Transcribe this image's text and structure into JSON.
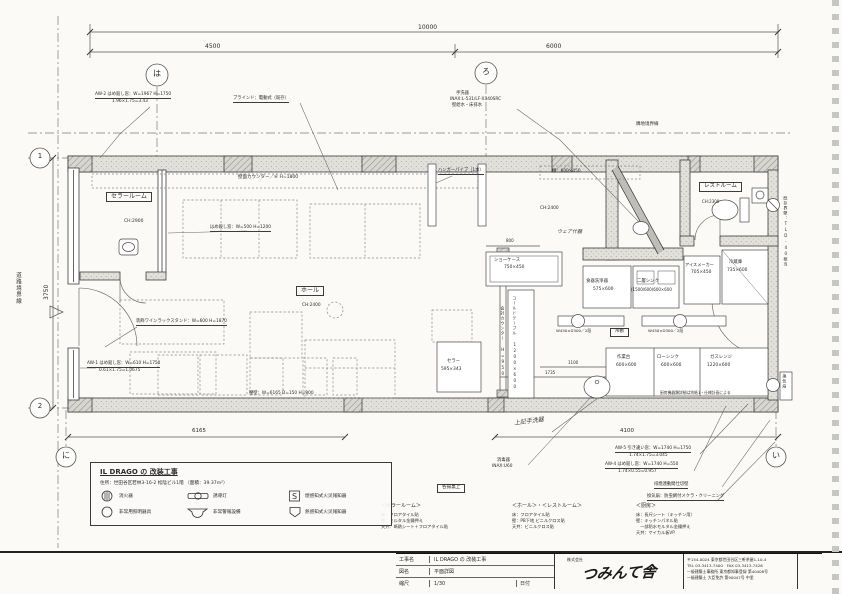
{
  "dims": {
    "overall": "10000",
    "span_left": "4500",
    "span_right": "6000",
    "depth": "3750",
    "bottom_left": "6165",
    "bottom_right": "4100",
    "inner_800": "800",
    "inner_1100": "1100",
    "inner_1735": "1735"
  },
  "grid": {
    "ha": "は",
    "ro": "ろ",
    "one": "1",
    "two": "2",
    "ni": "に",
    "i": "い"
  },
  "boundaries": {
    "road": "道路境界線",
    "adjacent": "隣地境界線",
    "wall_note": "既存界壁：TLD-40相当",
    "vent_label": "換気扇"
  },
  "rooms": {
    "cellar": {
      "name": "セラールーム",
      "ch": "CH:2900"
    },
    "hall": {
      "name": "ホール",
      "ch": "CH:2400"
    },
    "restroom": {
      "name": "レストルーム",
      "ch": "CH:2300"
    },
    "kitchen_note": "厨房機器類詳細は別紙1・仕様計画による"
  },
  "annotations": {
    "aw2_l1": "AW-2 はめ殺し窓：W=1967 H=1750",
    "aw2_l2": "1.96×1.75=3.43",
    "blind": "ブラインド：電動式（既存）",
    "basin_l1": "手洗器",
    "basin_l2": "INAX:L-531/LF-X340SRC",
    "basin_l3": "壁給水・床排水",
    "counter_top": "壁面カウンター／⑥ H=1800",
    "fix_window": "はめ殺し窓：W=500 H=1200",
    "wine_rack": "装飾ワインラックスタンド：W=600 H=1870",
    "aw1_l1": "AW-1 はめ殺し窓：W=610 H=1750",
    "aw1_l2": "0.61×1.75=1.0675",
    "low_wall": "腰壁：W=6165 D=150 H=800",
    "hand_note": "上記手洗器",
    "sanitizer_l1": "消毒器",
    "sanitizer_l2": "INAX:U60",
    "aw5_l1": "AW-5 引き違い窓：W=1740 H=1750",
    "aw5_l2": "1.74×1.75=3.045",
    "aw4_l1": "AW-4 はめ殺し窓：W=1740 H=550",
    "aw4_l2": "1.74×0.55=0.957",
    "smoke_wall": "排煙連動間仕切壁",
    "vent_fan": "換気扇：防虫網付メクラ・クリーニング",
    "box_note": "各揚裏上",
    "hanger": "ハンガーパイプ（1本）",
    "shelf": "棚：600×450",
    "wear_note": "ウェア什器",
    "counter_vert": "会計カウンター H=950"
  },
  "equipment": {
    "showcase": {
      "name": "ショーケース",
      "size": "750×450"
    },
    "cold_table": "コールドテーブル 1200×600",
    "cellar_unit": {
      "name": "セラー",
      "size": "595×343"
    },
    "dishwasher": {
      "name": "食器洗浄器",
      "size": "575×600"
    },
    "sink2": {
      "name": "二層シンク",
      "size": "(1500/600)600×600"
    },
    "ice": {
      "name": "アイスメーカー",
      "size": "705×450"
    },
    "fridge": {
      "name": "冷蔵庫",
      "size": "735×600"
    },
    "shelf_hang": {
      "name": "吊棚",
      "size": "W450×D300／2段"
    },
    "work": {
      "name": "作業台",
      "size": "600×600"
    },
    "low_sink": {
      "name": "ローシンク",
      "size": "600×600"
    },
    "range": {
      "name": "ガスレンジ",
      "size": "1220×600"
    }
  },
  "finishes": {
    "cellar": {
      "title": "＜セラールーム＞",
      "lines": [
        "床：フロアタイル貼",
        "壁：モルタル金鏝押え",
        "天井：断熱シート＋フロアタイル貼"
      ]
    },
    "hall": {
      "title": "＜ホール＞・＜レストルーム＞",
      "lines": [
        "床：フロアタイル貼",
        "壁：PB下地 ビニルクロス貼",
        "天井：ビニルクロス貼"
      ]
    },
    "kitchen": {
      "title": "＜厨房＞",
      "lines": [
        "床：長尺シート（キッチン用）",
        "壁：キッチンパネル貼",
        "　一部防水モルタル金鏝押え",
        "天井：ケイカル板VP"
      ]
    }
  },
  "legend": {
    "title": "IL DRAGO の 改装工事",
    "address": "住所：世田谷区若林3-16-2 松陰ビル1階 （面積：39.37m²）",
    "items": [
      {
        "label": "消火器"
      },
      {
        "label": "誘導灯"
      },
      {
        "label": "煙感知式火災報知器",
        "glyph": "S"
      },
      {
        "label": "非常用照明器具"
      },
      {
        "label": "非常警報設備"
      },
      {
        "label": "熱感知式火災報知器"
      }
    ]
  },
  "titleblock": {
    "rows": [
      {
        "label": "工事名",
        "value": "IL DRAGO の 改装工事"
      },
      {
        "label": "図名",
        "value": "平面詳図"
      },
      {
        "label": "縮尺",
        "value": "1/30",
        "extra": "日付"
      }
    ],
    "company_prefix": "株式会社",
    "company": "つみんて舎",
    "info": [
      "〒154-0024 東京都世田谷区三軒茶屋1-10-4",
      "TEL 03-3413-7400　FAX 03-3413-7426",
      "一級建築士事務所 東京都知事登録 第40408号",
      "一級建築士 大臣免許 第90047号 中里"
    ]
  }
}
